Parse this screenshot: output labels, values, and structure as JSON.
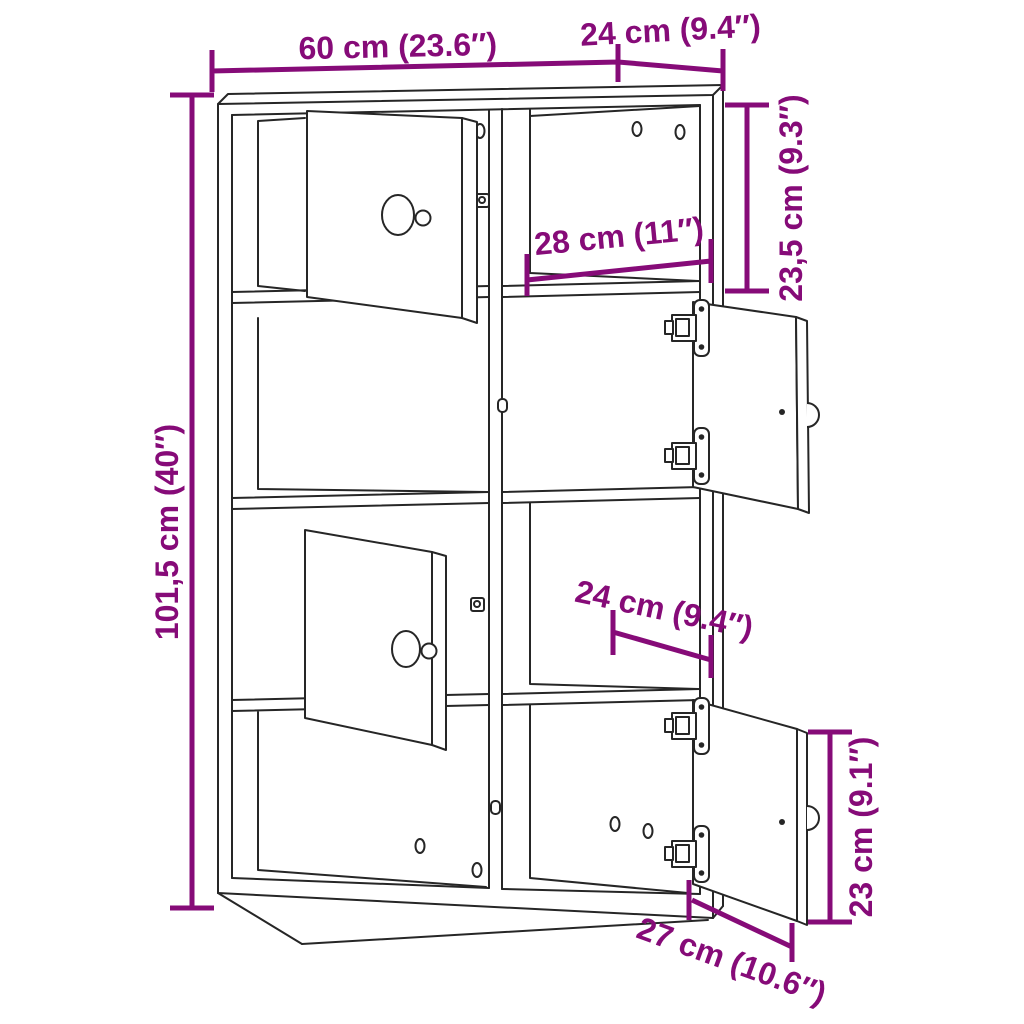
{
  "diagram": {
    "type": "furniture-dimension-diagram",
    "subject": "bookcase with 8 compartments and 4 open doors",
    "dimensions": {
      "overall_width": "60 cm (23.6″)",
      "overall_depth": "24 cm (9.4″)",
      "overall_height": "101,5 cm (40″)",
      "top_compartment_height": "23,5 cm (9.3″)",
      "compartment_width": "28 cm (11″)",
      "compartment_depth": "24 cm (9.4″)",
      "door_height": "23 cm (9.1″)",
      "door_width": "27 cm (10.6″)"
    }
  },
  "style": {
    "accent_color": "#860b78",
    "line_color": "#262626",
    "background_color": "#ffffff"
  }
}
